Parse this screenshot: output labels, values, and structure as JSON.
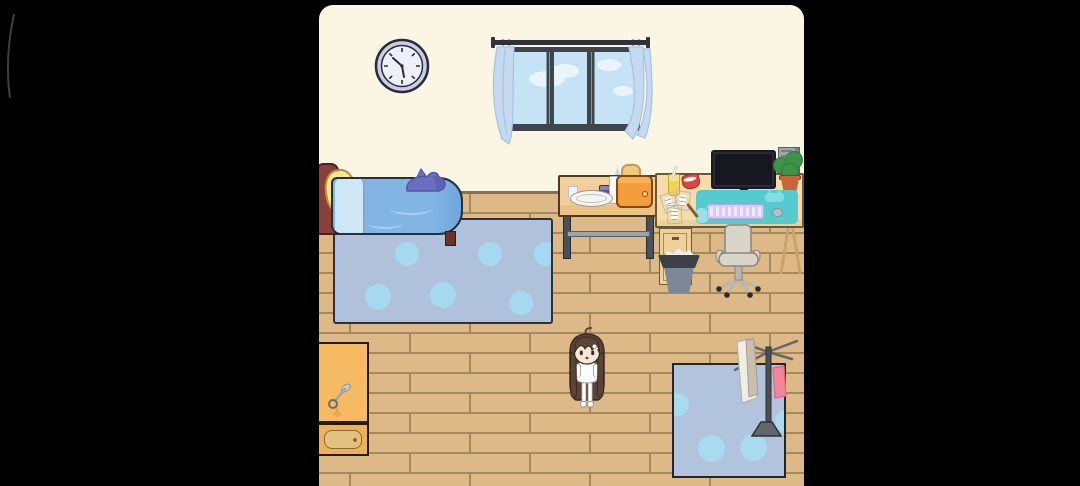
{
  "app": {
    "type": "casual room-decoration game scene",
    "view": "cozy bedroom interior, letterboxed on black background"
  },
  "clock": {
    "time_display": "approx 10:25"
  },
  "scene": {
    "objects": [
      {
        "name": "wall-clock",
        "label": "Wall clock"
      },
      {
        "name": "window",
        "label": "Sliding window with sky view"
      },
      {
        "name": "curtains",
        "label": "Light blue curtains"
      },
      {
        "name": "bed",
        "label": "Blue bed with yellow pillow"
      },
      {
        "name": "shark-plush",
        "label": "Purple shark plush on bed"
      },
      {
        "name": "rug",
        "label": "Blue polka-dot rug"
      },
      {
        "name": "breakfast-table",
        "label": "Breakfast table"
      },
      {
        "name": "toaster",
        "label": "Orange toaster with toast"
      },
      {
        "name": "milk-carton",
        "label": "Milk carton"
      },
      {
        "name": "jam-jar",
        "label": "Jam jar"
      },
      {
        "name": "glass",
        "label": "Glass"
      },
      {
        "name": "knife",
        "label": "Butter knife"
      },
      {
        "name": "plate",
        "label": "Plate"
      },
      {
        "name": "desk",
        "label": "Computer desk"
      },
      {
        "name": "monitor",
        "label": "Monitor"
      },
      {
        "name": "pc-tower",
        "label": "PC tower"
      },
      {
        "name": "desk-plant",
        "label": "Potted plant"
      },
      {
        "name": "desk-mat",
        "label": "Teal desk mat with cat motif"
      },
      {
        "name": "keyboard",
        "label": "Lavender keyboard"
      },
      {
        "name": "mouse",
        "label": "Mouse"
      },
      {
        "name": "bubble-tea",
        "label": "Yellow drink with straw"
      },
      {
        "name": "snack-bowl",
        "label": "Red snack bowl"
      },
      {
        "name": "papers",
        "label": "Scattered papers"
      },
      {
        "name": "pen",
        "label": "Pen"
      },
      {
        "name": "office-chair",
        "label": "Office chair"
      },
      {
        "name": "trash-can",
        "label": "Trash can with crumpled paper"
      },
      {
        "name": "shoe-cabinet",
        "label": "Orange cabinet with key"
      },
      {
        "name": "cabinet-drawer",
        "label": "Cabinet drawer"
      },
      {
        "name": "laundry-mat",
        "label": "Blue laundry mat"
      },
      {
        "name": "drying-rack",
        "label": "Drying rack with towels"
      },
      {
        "name": "girl-character",
        "label": "Girl character in white pajamas"
      }
    ]
  },
  "colors": {
    "bg": "#000000",
    "wall": "#FBF6E3",
    "floor_base": "#DDB987",
    "floor_line": "#A5895E",
    "floor_edge": "#8A7050",
    "clock_rim": "#C9CDE8",
    "clock_face": "#EEF0F9",
    "clock_mark": "#2A2A35",
    "window_frame": "#3F454D",
    "window_glass": "#C5E3F5",
    "window_cloud": "#EAF5FB",
    "curtain": "#C5D9F1",
    "curtain_fold": "#A9C2DF",
    "rod": "#2F3339",
    "headboard": "#8A4038",
    "headboard_dark": "#4A2018",
    "pillow": "#F6E794",
    "pillow_shade": "#E4C058",
    "blanket": "#82B4E4",
    "blanket_light": "#CEE6F6",
    "blanket_shade": "#6FA6DE",
    "blanket_line": "#A8CDF0",
    "outline": "#26303C",
    "shark": "#6B6FC0",
    "shark_dark": "#5458A8",
    "bed_leg": "#6B3226",
    "rug": "#AFC1DB",
    "rug_dot": "#A6D9EF",
    "rug_border": "#2E3237",
    "table_top": "#F4CE97",
    "table_front": "#EDC383",
    "table_border": "#4A3A26",
    "table_leg": "#4A5058",
    "table_bar": "#9AA4AE",
    "glass_cup": "#EDF3F6",
    "knife_blade": "#C9CFD4",
    "jam": "#5C5480",
    "jam_lid": "#8A84B0",
    "milk": "#FAFAF7",
    "milk_shade": "#C9D4DE",
    "toaster": "#F59D3B",
    "toaster_dark": "#7A4A14",
    "toast": "#F2CA7E",
    "toast_crust": "#C89850",
    "plate": "#F4F4F0",
    "plate_rim": "#9A9A94",
    "desk_top": "#F6DCA9",
    "desk_front": "#EED09A",
    "desk_border": "#6A5638",
    "desk_leg": "#C9A36B",
    "mat": "#55CACF",
    "mat_light": "#8FE0E2",
    "keyboard": "#D9CAF4",
    "keyboard_key": "#F0E8FC",
    "mouse": "#B9BEC4",
    "monitor": "#2B2B36",
    "screen": "#17171F",
    "tower": "#9EA6AC",
    "tower_dark": "#788086",
    "pot": "#C8653A",
    "pot_dark": "#8A4020",
    "plant": "#3F9347",
    "plant_dark": "#2F7A38",
    "drink": "#F2D355",
    "bowl_red": "#D8483C",
    "paper": "#FFFFFF",
    "paper_line": "#AAAAAA",
    "pen": "#8A5A30",
    "chair": "#D9D5CB",
    "chair_line": "#8A867C",
    "chair_metal": "#B8B6AE",
    "caster": "#2A2A2A",
    "trash_rim": "#3C4048",
    "trash_body": "#7C8798",
    "trash_paper": "#EFEFEA",
    "cabinet": "#F5BA62",
    "cabinet_border": "#241C10",
    "drawer_face": "#F0B058",
    "drawer_inner": "#E3C180",
    "drawer_line": "#8A6A3A",
    "key_metal": "#9AA4AC",
    "flower": "#E8A24A",
    "mat2": "#B1C3DD",
    "mat2_circle": "#A8DBF0",
    "mat2_border": "#24262B",
    "rack": "#63666C",
    "towel_cream": "#EFEDE6",
    "towel_tan": "#CBBEAE",
    "towel_pink": "#F2879C",
    "towel_pink_dark": "#D86A82",
    "hair": "#5C4338",
    "hair_dark": "#3A2A22",
    "skin": "#F8E7D7",
    "white_cloth": "#FCFCFC",
    "cloth_line": "#9C948A",
    "arc": "#4A4A4A"
  }
}
